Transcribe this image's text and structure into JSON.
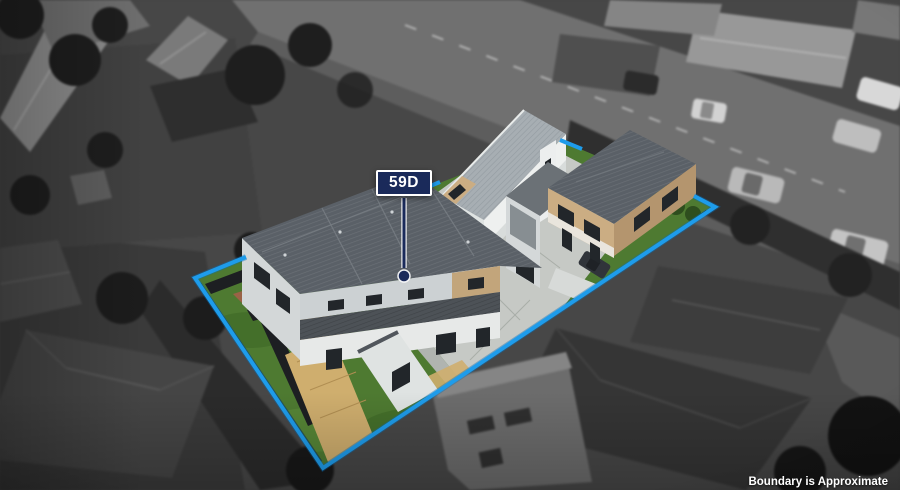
{
  "marker": {
    "label": "59D"
  },
  "disclaimer": {
    "text": "Boundary is Approximate"
  },
  "colors": {
    "boundary": "#1e9ceb",
    "marker_bg": "#1a2a5a",
    "marker_border": "#ffffff",
    "marker_text": "#ffffff",
    "disclaimer_text": "#ffffff",
    "grass": "#4e7a31",
    "deck_timber": "#cfae6e",
    "deck_brown": "#9a6246",
    "roof_dark": "#5a6067",
    "wall_white": "#eef0ef",
    "wall_tan": "#cbad83",
    "concrete": "#c6c9c5"
  }
}
